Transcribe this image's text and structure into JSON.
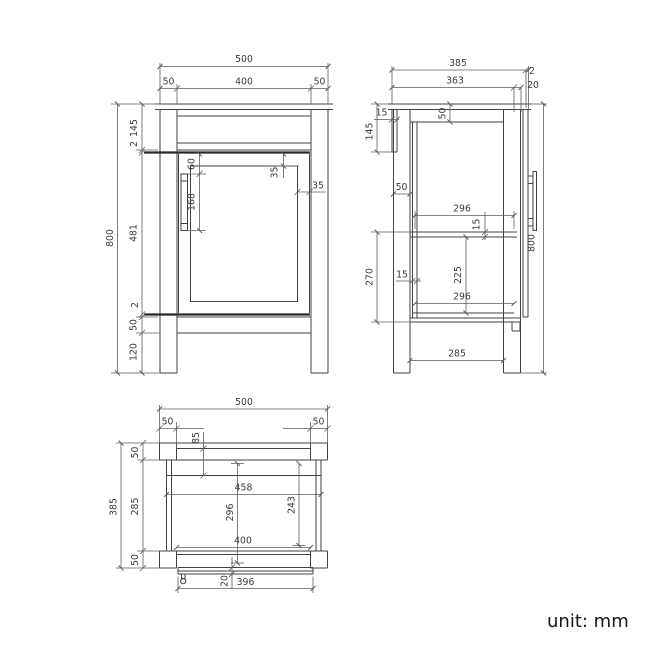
{
  "front": {
    "overall_width": "500",
    "left_leg": "50",
    "opening_width": "400",
    "right_leg": "50",
    "top_height": "145",
    "top_gap": "2",
    "total_height": "800",
    "door_height": "481",
    "bottom_gap": "2",
    "rail_height": "50",
    "foot_height": "120",
    "handle_offset": "60",
    "handle_length": "168",
    "frame_top": "35",
    "frame_side": "35"
  },
  "side": {
    "overall_depth": "385",
    "back_panel_gap": "2",
    "body_depth": "363",
    "door_thickness": "20",
    "back_strip": "15",
    "top_height": "145",
    "top_rail": "50",
    "leg_width": "50",
    "interior_depth_top": "296",
    "shelf_thickness": "15",
    "lower_height": "270",
    "wall_thickness": "15",
    "under_shelf": "225",
    "interior_depth_bottom": "296",
    "total_height": "800",
    "leg_spacing": "285"
  },
  "plan": {
    "overall_width": "500",
    "left_leg": "50",
    "right_leg": "50",
    "back_inset": "85",
    "back_rail": "50",
    "overall_depth": "385",
    "interior_depth": "285",
    "carcass_width": "458",
    "interior_length": "296",
    "shelf_depth": "243",
    "opening_width": "400",
    "front_rail": "50",
    "door_gap": "20",
    "door_width": "396"
  },
  "footer": {
    "unit_label": "unit: mm"
  },
  "colors": {
    "line": "#424242",
    "bold_line": "#272727",
    "dim_line": "#5d5d5d",
    "text": "#3a3a3a",
    "background": "#ffffff"
  }
}
